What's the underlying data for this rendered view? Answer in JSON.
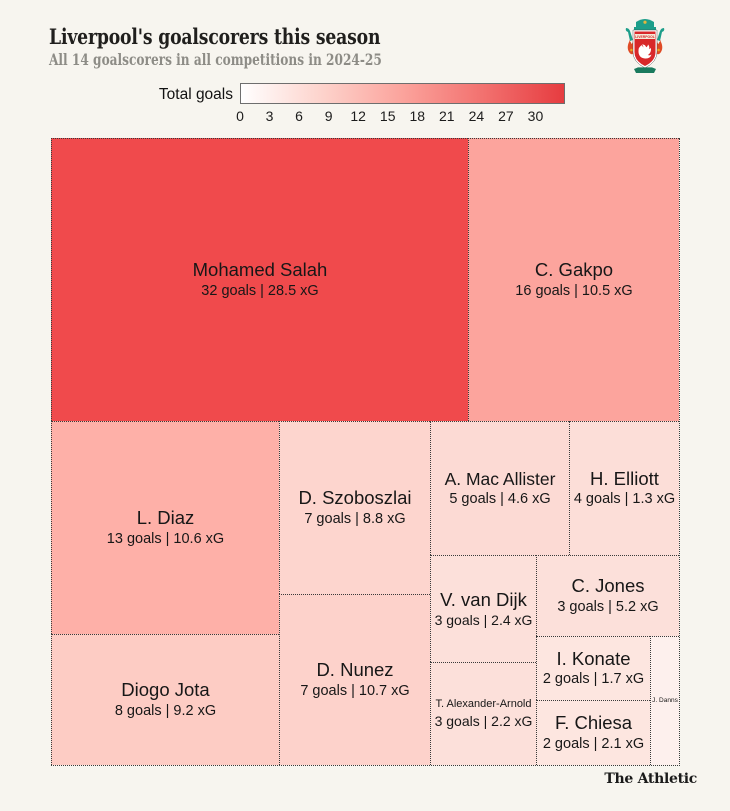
{
  "header": {
    "title": "Liverpool's goalscorers this season",
    "subtitle": "All 14 goalscorers in all competitions in 2024-25"
  },
  "legend": {
    "label": "Total goals",
    "ticks": [
      0,
      3,
      6,
      9,
      12,
      15,
      18,
      21,
      24,
      27,
      30
    ],
    "scale_max": 33,
    "gradient": [
      "#ffffff",
      "#fdd3cc",
      "#fba39c",
      "#f2716f",
      "#e63c40"
    ]
  },
  "footer": {
    "wordmark": "The Athletic"
  },
  "icons": {
    "crest": "liverpool-crest-icon"
  },
  "colors": {
    "background": "#f7f5ef",
    "cell_border": "#3a3a3a",
    "title_text": "#201f1d",
    "subtitle_text": "#8d8c86",
    "cell_text": "#171717"
  },
  "chart_data": {
    "type": "treemap",
    "title": "Liverpool's goalscorers this season",
    "subtitle": "All 14 goalscorers in all competitions in 2024-25",
    "color_scale": {
      "label": "Total goals",
      "min": 0,
      "max": 33,
      "ticks": [
        0,
        3,
        6,
        9,
        12,
        15,
        18,
        21,
        24,
        27,
        30
      ]
    },
    "players": [
      {
        "name": "Mohamed Salah",
        "goals": 32,
        "xg": 28.5,
        "stats": "32 goals | 28.5 xG",
        "color": "#f04a4c",
        "rect": {
          "x": 0,
          "y": 0,
          "w": 417,
          "h": 283
        },
        "name_px": 18.5,
        "stats_px": 14.5
      },
      {
        "name": "C. Gakpo",
        "goals": 16,
        "xg": 10.5,
        "stats": "16 goals | 10.5 xG",
        "color": "#fca49d",
        "rect": {
          "x": 417,
          "y": 0,
          "w": 211,
          "h": 283
        },
        "name_px": 18.5,
        "stats_px": 14.5
      },
      {
        "name": "L. Diaz",
        "goals": 13,
        "xg": 10.6,
        "stats": "13 goals | 10.6 xG",
        "color": "#feb0a8",
        "rect": {
          "x": 0,
          "y": 283,
          "w": 228,
          "h": 213
        },
        "name_px": 18.5,
        "stats_px": 14.5
      },
      {
        "name": "D. Szoboszlai",
        "goals": 7,
        "xg": 8.8,
        "stats": "7 goals | 8.8 xG",
        "color": "#fdd5ce",
        "rect": {
          "x": 228,
          "y": 283,
          "w": 151,
          "h": 173
        },
        "name_px": 18.5,
        "stats_px": 14.5
      },
      {
        "name": "A. Mac Allister",
        "goals": 5,
        "xg": 4.6,
        "stats": "5 goals | 4.6 xG",
        "color": "#fcdad4",
        "rect": {
          "x": 379,
          "y": 283,
          "w": 139,
          "h": 134
        },
        "name_px": 17.5,
        "stats_px": 14.5
      },
      {
        "name": "H. Elliott",
        "goals": 4,
        "xg": 1.3,
        "stats": "4 goals | 1.3 xG",
        "color": "#fcded8",
        "rect": {
          "x": 518,
          "y": 283,
          "w": 110,
          "h": 134
        },
        "name_px": 18.5,
        "stats_px": 14.5
      },
      {
        "name": "V. van Dijk",
        "goals": 3,
        "xg": 2.4,
        "stats": "3 goals | 2.4 xG",
        "color": "#fce0da",
        "rect": {
          "x": 379,
          "y": 417,
          "w": 106,
          "h": 107
        },
        "name_px": 18.5,
        "stats_px": 14
      },
      {
        "name": "C. Jones",
        "goals": 3,
        "xg": 5.2,
        "stats": "3 goals | 5.2 xG",
        "color": "#fce0da",
        "rect": {
          "x": 485,
          "y": 417,
          "w": 143,
          "h": 81
        },
        "name_px": 18.5,
        "stats_px": 14.5
      },
      {
        "name": "Diogo Jota",
        "goals": 8,
        "xg": 9.2,
        "stats": "8 goals | 9.2 xG",
        "color": "#fdccc4",
        "rect": {
          "x": 0,
          "y": 496,
          "w": 228,
          "h": 131
        },
        "name_px": 18.5,
        "stats_px": 14.5
      },
      {
        "name": "D. Nunez",
        "goals": 7,
        "xg": 10.7,
        "stats": "7 goals | 10.7 xG",
        "color": "#fdd2cb",
        "rect": {
          "x": 228,
          "y": 456,
          "w": 151,
          "h": 171
        },
        "name_px": 18.5,
        "stats_px": 14.5
      },
      {
        "name": "T. Alexander-Arnold",
        "goals": 3,
        "xg": 2.2,
        "stats": "3 goals | 2.2 xG",
        "color": "#fce0da",
        "rect": {
          "x": 379,
          "y": 524,
          "w": 106,
          "h": 103
        },
        "name_px": 11,
        "stats_px": 14
      },
      {
        "name": "I. Konate",
        "goals": 2,
        "xg": 1.7,
        "stats": "2 goals | 1.7 xG",
        "color": "#fde6e0",
        "rect": {
          "x": 485,
          "y": 498,
          "w": 114,
          "h": 64
        },
        "name_px": 18.5,
        "stats_px": 14.5
      },
      {
        "name": "F. Chiesa",
        "goals": 2,
        "xg": 2.1,
        "stats": "2 goals | 2.1 xG",
        "color": "#fde6e0",
        "rect": {
          "x": 485,
          "y": 562,
          "w": 114,
          "h": 65
        },
        "name_px": 18.5,
        "stats_px": 14.5
      },
      {
        "name": "J. Danns",
        "color": "#fdf0ed",
        "rect": {
          "x": 599,
          "y": 498,
          "w": 29,
          "h": 129
        },
        "name_px": 6.5
      }
    ]
  }
}
